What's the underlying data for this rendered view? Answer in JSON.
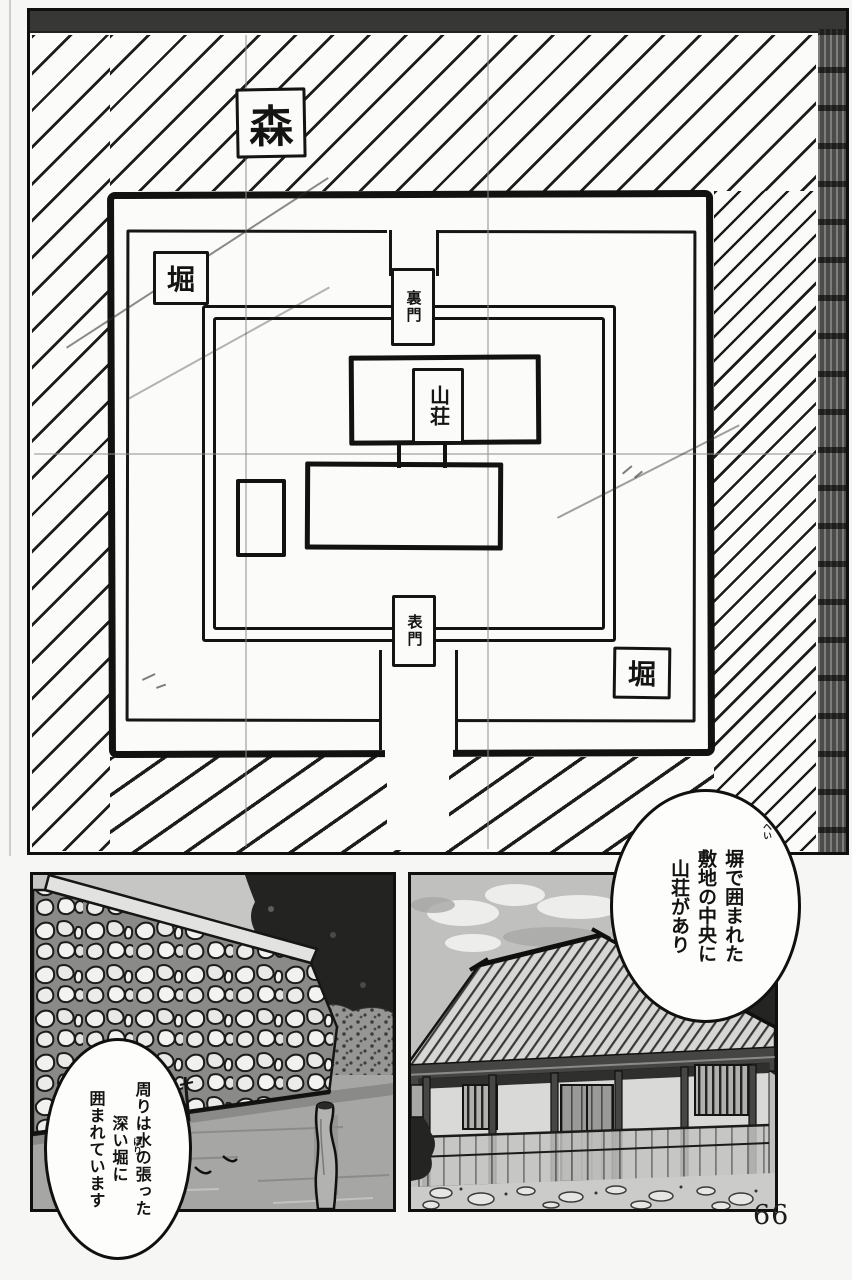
{
  "page": {
    "number": "66",
    "paper_color": "#f6f6f4",
    "ink_color": "#141412"
  },
  "map": {
    "forest_label": "森",
    "moat_label_top": "堀",
    "moat_label_bottom": "堀",
    "back_gate_label": "裏門",
    "front_gate_label": "表門",
    "villa_label": "山荘"
  },
  "bubbles": {
    "villa": {
      "lines": [
        "塀で囲まれた",
        "敷地の中央に",
        "山荘があり"
      ],
      "furigana": "へい"
    },
    "moat": {
      "lines": [
        "周りは水の張った",
        "深い堀に",
        "囲まれています"
      ],
      "furigana": "ほり"
    }
  }
}
